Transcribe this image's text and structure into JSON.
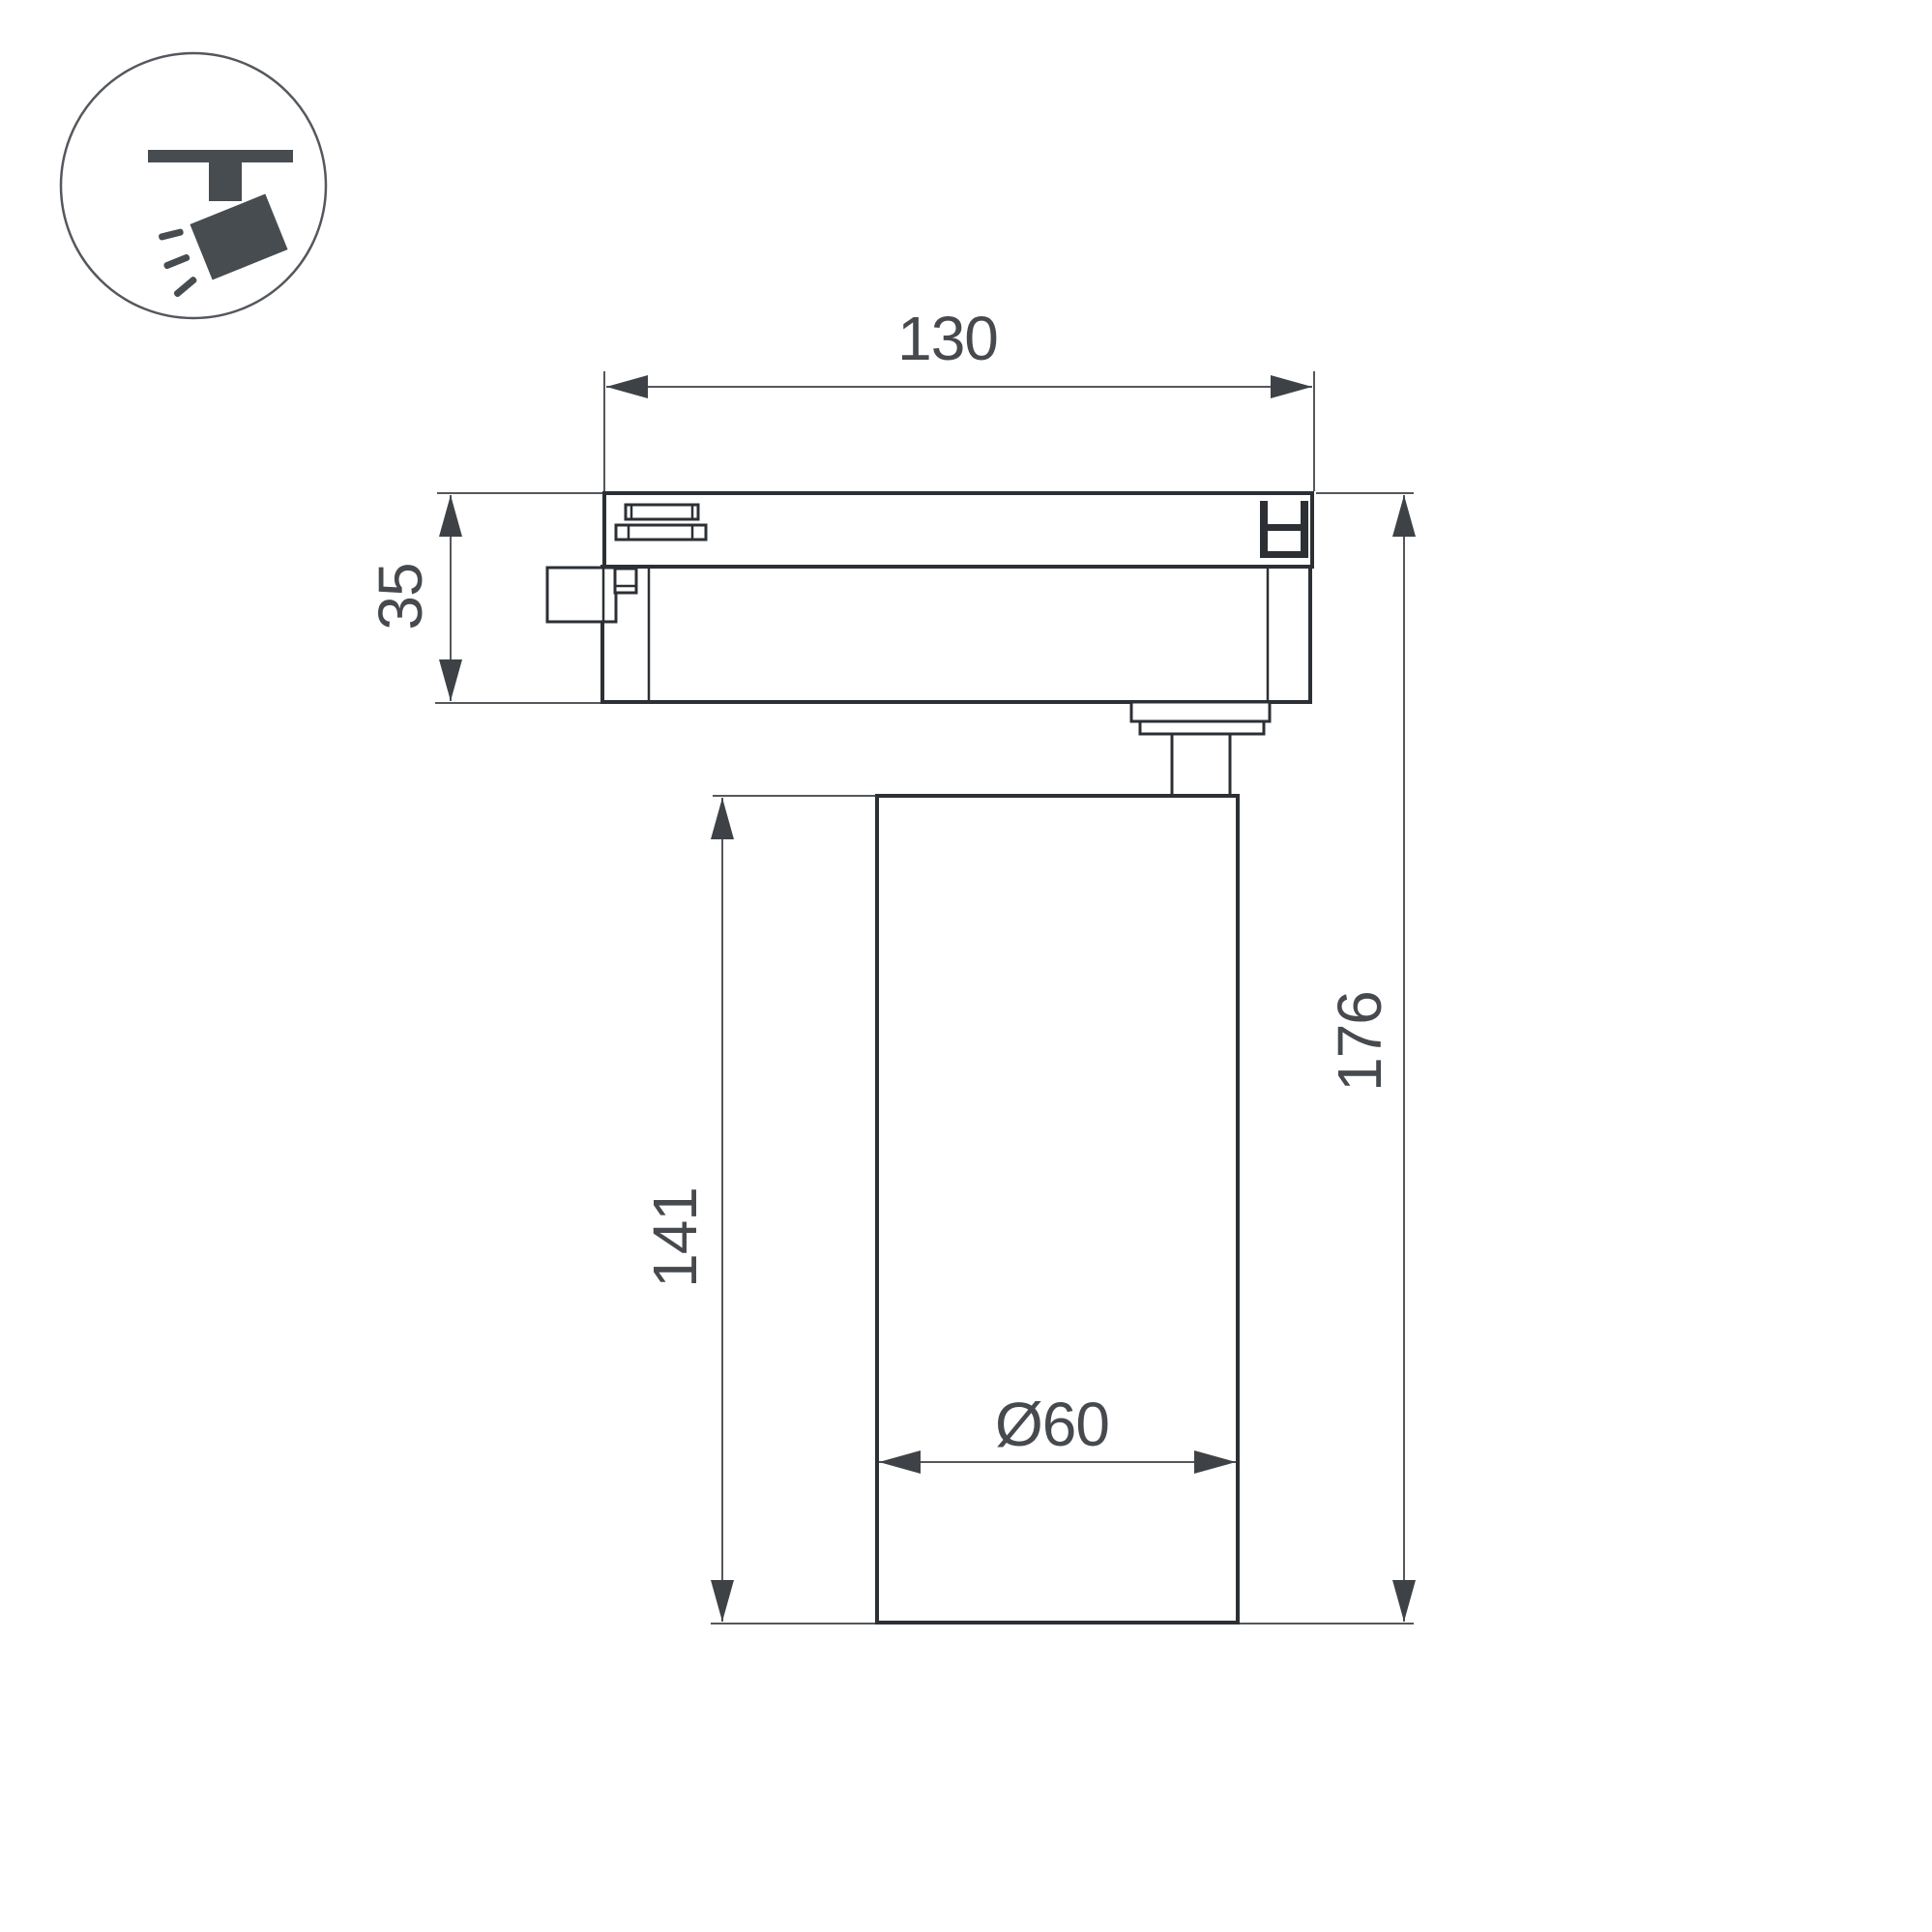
{
  "canvas": {
    "background": "#ffffff"
  },
  "icon": {
    "name": "ceiling-track-spotlight-pictogram",
    "glyph_color": "#474c51",
    "ring_color": "#54585d"
  },
  "drawing": {
    "subject": "track-mounted cylindrical spotlight, side elevation",
    "outline_color": "#2c3034",
    "dimension_line_color": "#54585c",
    "dimension_text_color": "#46494d",
    "dimensions": {
      "track_width": "130",
      "adapter_height": "35",
      "body_height": "141",
      "overall_height": "176",
      "body_diameter": "Ø60"
    }
  }
}
